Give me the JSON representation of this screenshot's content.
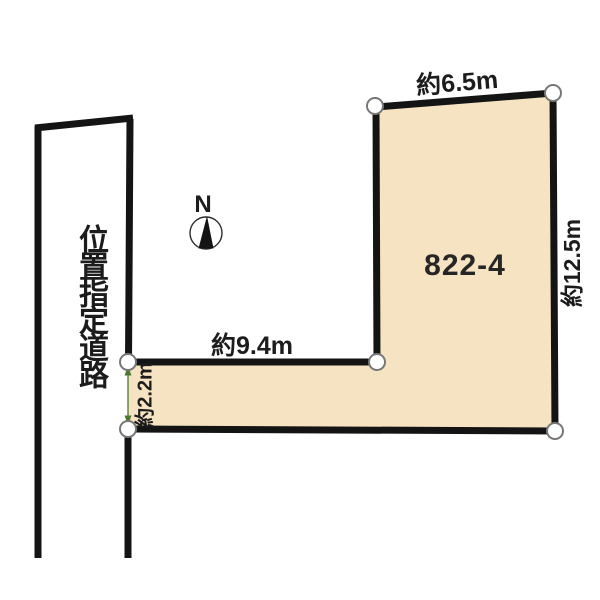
{
  "diagram_type": "land-plot-survey-diagram",
  "parcel": {
    "number": "822-4"
  },
  "road": {
    "label": "位置指定道路"
  },
  "compass": {
    "label": "N"
  },
  "dimensions": {
    "top_edge": "約6.5m",
    "right_edge": "約12.5m",
    "inner_edge": "約9.4m",
    "road_frontage": "約2.2m"
  },
  "colors": {
    "background": "#ffffff",
    "parcel_fill": "#f6e3c2",
    "outline": "#141414",
    "marker_fill": "#ffffff",
    "marker_stroke": "#777777",
    "dimension_arrow": "#4a7a2f",
    "text": "#1c1c1c"
  }
}
